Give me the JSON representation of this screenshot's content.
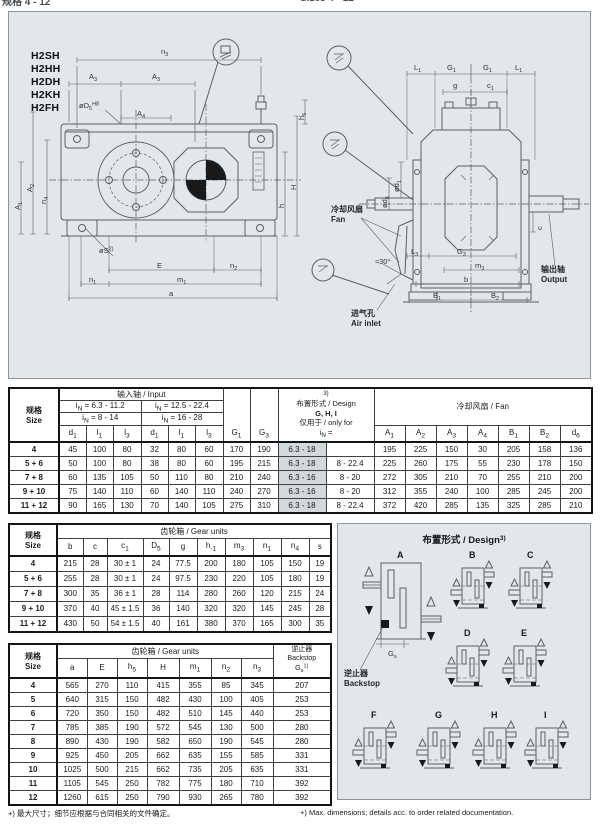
{
  "page": {
    "clipped_header_left": "规格 4 - 12",
    "clipped_header_right": "Sizes 4 - 12",
    "footnote_zh": "+) 最大尺寸；细节应根据与合同相关的文件确定。",
    "footnote_en": "+) Max. dimensions; details acc. to order related documentation."
  },
  "models": [
    "H2SH",
    "H2HH",
    "H2DH",
    "H2KH",
    "H2FH"
  ],
  "drawing": {
    "left_labels": {
      "n3": "n_{3}",
      "a3a": "A_{3}",
      "a3b": "A_{3}",
      "d5": "øD_{5}^{H8}",
      "a4": "A_{4}",
      "a1": "A_{1}",
      "a2": "A_{2}",
      "n4": "n_{4}",
      "h5": "h_{5}",
      "H": "H",
      "h": "h",
      "s": "øS^{2)}",
      "E": "E",
      "n2": "n_{2}",
      "n1": "n_{1}",
      "m1": "m_{1}",
      "a": "a"
    },
    "right_labels": {
      "l1a": "L_{1}",
      "g1a": "G_{1}",
      "g1b": "G_{1}",
      "l1b": "L_{1}",
      "g": "g",
      "c1": "c_{1}",
      "d1": "ød_{1}",
      "d6": "ød_{6}",
      "c": "c",
      "l3": "L_{3}",
      "g3": "G_{3}",
      "m3": "m_{3}",
      "b": "b",
      "b1": "B_{1}",
      "b2": "B_{2}",
      "angle": "≈30°",
      "fan_zh": "冷却风扇",
      "fan_en": "Fan",
      "air_zh": "进气孔",
      "air_en": "Air inlet",
      "out_zh": "输出轴",
      "out_en": "Output"
    }
  },
  "table1": {
    "size_zh": "规格",
    "size_en": "Size",
    "input_group": "输入轴 / Input",
    "in_range1a": "i_{N} = 6.3 - 11.2",
    "in_range2a": "i_{N} = 12.5 - 22.4",
    "in_range1b": "i_{N} = 8 - 14",
    "in_range2b": "i_{N} = 16 - 28",
    "cols": [
      "d_{1}",
      "l_{1}",
      "l_{3}",
      "d_{1}",
      "l_{1}",
      "l_{3}"
    ],
    "g1": "G_{1}",
    "g3": "G_{3}",
    "design_sup": "3)",
    "design_title": "布置形式 / Design",
    "design_bold": "G, H, I",
    "design_only": "仅用于 / only for",
    "design_in": "i_{N} =",
    "fan_group": "冷却风扇 / Fan",
    "fan_cols": [
      "A_{1}",
      "A_{2}",
      "A_{3}",
      "A_{4}",
      "B_{1}",
      "B_{2}",
      "d_{6}"
    ],
    "rows": [
      {
        "size": "4",
        "vals": [
          "45",
          "100",
          "80",
          "32",
          "80",
          "60",
          "170",
          "190",
          "6.3 - 18",
          "",
          "195",
          "225",
          "150",
          "30",
          "205",
          "158",
          "136"
        ]
      },
      {
        "size": "5 + 6",
        "vals": [
          "50",
          "100",
          "80",
          "38",
          "80",
          "60",
          "195",
          "215",
          "6.3 - 18",
          "8 - 22.4",
          "225",
          "260",
          "175",
          "55",
          "230",
          "178",
          "150"
        ]
      },
      {
        "size": "7 + 8",
        "vals": [
          "60",
          "135",
          "105",
          "50",
          "110",
          "80",
          "210",
          "240",
          "6.3 - 16",
          "8 - 20",
          "272",
          "305",
          "210",
          "70",
          "255",
          "210",
          "200"
        ]
      },
      {
        "size": "9 + 10",
        "vals": [
          "75",
          "140",
          "110",
          "60",
          "140",
          "110",
          "240",
          "270",
          "6.3 - 16",
          "8 - 20",
          "312",
          "355",
          "240",
          "100",
          "285",
          "245",
          "200"
        ]
      },
      {
        "size": "11 + 12",
        "vals": [
          "90",
          "165",
          "130",
          "70",
          "140",
          "105",
          "275",
          "310",
          "6.3 - 18",
          "8 - 22.4",
          "372",
          "420",
          "285",
          "135",
          "325",
          "285",
          "210"
        ]
      }
    ]
  },
  "table2": {
    "size_zh": "规格",
    "size_en": "Size",
    "group": "齿轮箱 / Gear units",
    "cols": [
      "b",
      "c",
      "c_{1}",
      "D_{5}",
      "g",
      "h_{-1}",
      "m_{3}",
      "n_{1}",
      "n_{4}",
      "s"
    ],
    "rows": [
      {
        "size": "4",
        "vals": [
          "215",
          "28",
          "30 ± 1",
          "24",
          "77.5",
          "200",
          "180",
          "105",
          "150",
          "19"
        ]
      },
      {
        "size": "5 + 6",
        "vals": [
          "255",
          "28",
          "30 ± 1",
          "24",
          "97.5",
          "230",
          "220",
          "105",
          "180",
          "19"
        ]
      },
      {
        "size": "7 + 8",
        "vals": [
          "300",
          "35",
          "36 ± 1",
          "28",
          "114",
          "280",
          "260",
          "120",
          "215",
          "24"
        ]
      },
      {
        "size": "9 + 10",
        "vals": [
          "370",
          "40",
          "45 ± 1.5",
          "36",
          "140",
          "320",
          "320",
          "145",
          "245",
          "28"
        ]
      },
      {
        "size": "11 + 12",
        "vals": [
          "430",
          "50",
          "54 ± 1.5",
          "40",
          "161",
          "380",
          "370",
          "165",
          "300",
          "35"
        ]
      }
    ]
  },
  "table3": {
    "size_zh": "规格",
    "size_en": "Size",
    "group": "齿轮箱 / Gear units",
    "cols": [
      "a",
      "E",
      "h_{5}",
      "H",
      "m_{1}",
      "n_{2}",
      "n_{3}"
    ],
    "backstop_zh": "逆止器",
    "backstop_en": "Backstop",
    "backstop_gs": "G_{s}^{1)}",
    "rows": [
      {
        "size": "4",
        "vals": [
          "565",
          "270",
          "110",
          "415",
          "355",
          "85",
          "345",
          "207"
        ]
      },
      {
        "size": "5",
        "vals": [
          "640",
          "315",
          "150",
          "482",
          "430",
          "100",
          "405",
          "253"
        ]
      },
      {
        "size": "6",
        "vals": [
          "720",
          "350",
          "150",
          "482",
          "510",
          "145",
          "440",
          "253"
        ]
      },
      {
        "size": "7",
        "vals": [
          "785",
          "385",
          "190",
          "572",
          "545",
          "130",
          "500",
          "280"
        ]
      },
      {
        "size": "8",
        "vals": [
          "890",
          "430",
          "190",
          "582",
          "650",
          "190",
          "545",
          "280"
        ]
      },
      {
        "size": "9",
        "vals": [
          "925",
          "450",
          "205",
          "662",
          "635",
          "155",
          "585",
          "331"
        ]
      },
      {
        "size": "10",
        "vals": [
          "1025",
          "500",
          "215",
          "662",
          "735",
          "205",
          "635",
          "331"
        ]
      },
      {
        "size": "11",
        "vals": [
          "1105",
          "545",
          "250",
          "782",
          "775",
          "180",
          "710",
          "392"
        ]
      },
      {
        "size": "12",
        "vals": [
          "1260",
          "615",
          "250",
          "790",
          "930",
          "265",
          "780",
          "392"
        ]
      }
    ]
  },
  "design_panel": {
    "title": "布置形式 / Design",
    "title_sup": "3)",
    "variants": [
      "A",
      "B",
      "C",
      "D",
      "E",
      "F",
      "G",
      "H",
      "I"
    ],
    "gs": "G_{s}",
    "backstop_zh": "逆止器",
    "backstop_en": "Backstop"
  }
}
